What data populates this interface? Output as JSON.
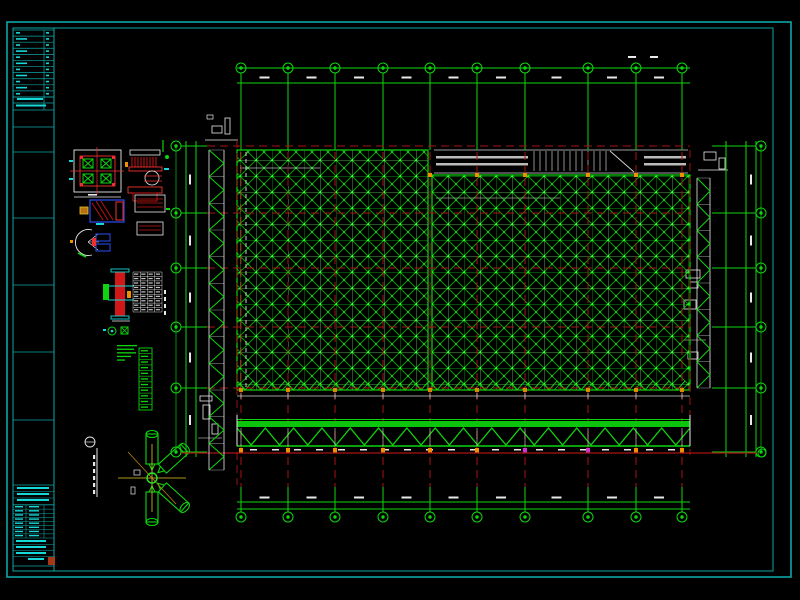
{
  "document": {
    "kind": "cad-structural-drawing",
    "description": "Black-background CAD sheet: space-frame (grid truss) roof plan with axis bubbles, edge truss elevations, detail drawings and a title strip on the left"
  },
  "colors": {
    "background": "#000000",
    "frame": "#0da6a6",
    "frame_text": "#17d8d8",
    "grid_green": "#00a000",
    "diag_green": "#00bb00",
    "node_green": "#28e628",
    "bright_green": "#0ed60e",
    "axis_red": "#a81414",
    "bright_red": "#f03030",
    "white": "#e9e9e9",
    "overlay_gray": "#cfcfcf",
    "orange": "#f09000",
    "yellow": "#e3c52a",
    "blue": "#2747e0",
    "magenta": "#cc33cc",
    "stamp_red": "#b03818"
  },
  "sheet": {
    "outer_frame": {
      "x": 7,
      "y": 22,
      "w": 784,
      "h": 555
    },
    "inner_frame": {
      "x": 13,
      "y": 28,
      "w": 760,
      "h": 543
    },
    "title_strip": {
      "x": 13,
      "right_x": 54,
      "divider_x": 44,
      "top_table": {
        "y1": 30,
        "y2": 97,
        "rows": 11
      },
      "text_rows_y": [
        97,
        103,
        110
      ],
      "mid_box_lines_y": [
        127,
        152,
        218,
        285,
        352,
        420
      ],
      "bottom_table": {
        "y1": 485,
        "grid_y1": 505,
        "grid_y2": 538,
        "grid_rows": 8,
        "y2": 566
      },
      "stamp": {
        "x": 48,
        "y": 557,
        "w": 7,
        "h": 8
      }
    }
  },
  "plan": {
    "col_axes_x": [
      241,
      288,
      335,
      383,
      430,
      477,
      525,
      588,
      636,
      682
    ],
    "row_axes_y": [
      146,
      213,
      268,
      327,
      388,
      452
    ],
    "red_row_axes_y": [
      146,
      213,
      268,
      327,
      388
    ],
    "bubble_r": 5,
    "top_bubble_cy": 68,
    "bottom_bubble_cy": 517,
    "left_bubble_cx": 176,
    "right_bubble_cx": 761,
    "top_dim_lines_y": [
      68,
      83
    ],
    "bottom_dim_lines_y": [
      502,
      509
    ],
    "left_dim_x": [
      186,
      196
    ],
    "right_dim_x": [
      726,
      746,
      756
    ],
    "left_block": {
      "x": 237,
      "y": 150,
      "w": 191,
      "h": 240
    },
    "right_block": {
      "x": 432,
      "y": 175,
      "w": 258,
      "h": 215
    },
    "cell_size": 16,
    "overlay_cell": 32,
    "stair_band": {
      "x": 434,
      "y": 150,
      "w": 254,
      "h": 23
    }
  },
  "bottom_truss": {
    "x1": 237,
    "x2": 690,
    "chord_top_y": 421,
    "chord_top_h": 6,
    "web_top_y": 428,
    "web_bot_y": 445,
    "chord_bot_y": 446,
    "panels": 16,
    "marker_y": 448,
    "magenta_marker_x": [
      525,
      588
    ],
    "dim_dash_y": 449,
    "red_line_y": 453,
    "red_line_x1": 181,
    "red_line_x2": 757,
    "end_bubble_x": 762
  },
  "edge_trusses": {
    "left": {
      "x1": 209,
      "x2": 224,
      "y1": 150,
      "y2": 470,
      "panels": 12
    },
    "right": {
      "x1": 697,
      "x2": 710,
      "y1": 178,
      "y2": 388,
      "panels": 8
    }
  },
  "details_legend": {
    "material_table": {
      "x": 133,
      "y": 272,
      "w": 29,
      "h": 40,
      "rows": 9,
      "cols": 4
    },
    "legend_strip": {
      "x": 139,
      "y": 348,
      "w": 13,
      "h": 62,
      "rows": 11
    },
    "notes_dash_widths": [
      20,
      17,
      19,
      14,
      8
    ]
  }
}
